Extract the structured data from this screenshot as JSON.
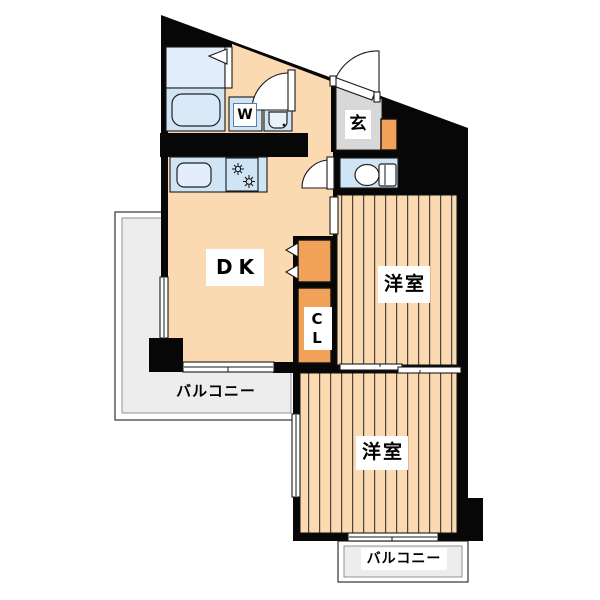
{
  "title": "apartment-floor-plan",
  "rooms": {
    "dk": {
      "label": "DK"
    },
    "western_room_upper": {
      "label": "洋室"
    },
    "western_room_lower": {
      "label": "洋室"
    },
    "closet": {
      "label": "CL"
    },
    "entrance": {
      "label": "玄"
    },
    "washer": {
      "label": "W"
    },
    "balcony_left": {
      "label": "バルコニー"
    },
    "balcony_bottom": {
      "label": "バルコニー"
    }
  },
  "icons": {
    "bathtub": "rounded-rect-tub",
    "washing_machine": "boxed-W",
    "vanity_sink": "basin-with-faucet-dot",
    "kitchen_sink": "rounded-rect-sink",
    "stove": "two-burner-star-glyphs",
    "toilet": "bowl-ellipse-with-tank",
    "doors": "quarter-circle-swing-arcs",
    "closet_doors": "white-fold-triangles"
  },
  "colors": {
    "wall": "#070707",
    "floor": "#fbd9b1",
    "stripe": "#4a443c",
    "closet_orange": "#f2a159",
    "fixture_blue": "#cfe4f5",
    "fixture_blue_light": "#e2edfb",
    "entrance_gray": "#d8d8d8",
    "balcony_gray": "#ededed"
  }
}
